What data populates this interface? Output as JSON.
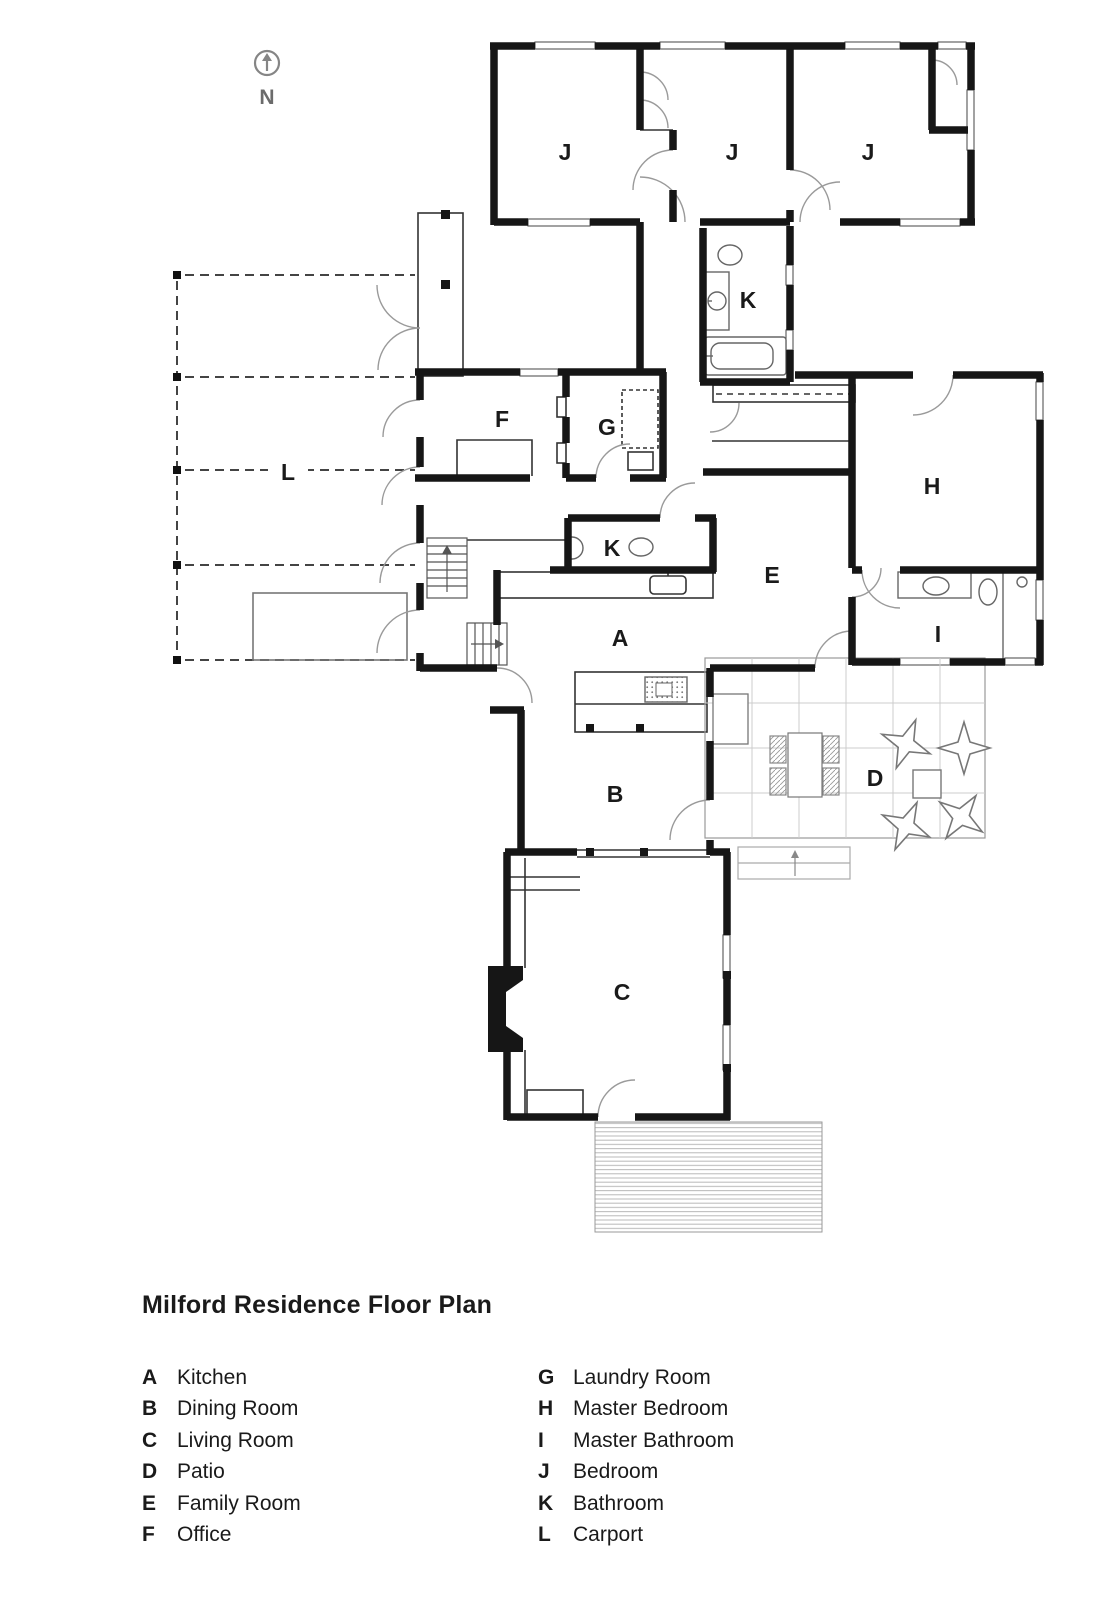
{
  "north_indicator": {
    "label": "N"
  },
  "plan": {
    "rooms": [
      {
        "id": "bedroom-1",
        "label": "J"
      },
      {
        "id": "bedroom-2",
        "label": "J"
      },
      {
        "id": "bedroom-3",
        "label": "J"
      },
      {
        "id": "bathroom-upper",
        "label": "K"
      },
      {
        "id": "office",
        "label": "F"
      },
      {
        "id": "laundry-room",
        "label": "G"
      },
      {
        "id": "carport",
        "label": "L"
      },
      {
        "id": "master-bedroom",
        "label": "H"
      },
      {
        "id": "bathroom-mid",
        "label": "K"
      },
      {
        "id": "family-room",
        "label": "E"
      },
      {
        "id": "master-bathroom",
        "label": "I"
      },
      {
        "id": "kitchen",
        "label": "A"
      },
      {
        "id": "dining-room",
        "label": "B"
      },
      {
        "id": "patio",
        "label": "D"
      },
      {
        "id": "living-room",
        "label": "C"
      }
    ]
  },
  "footer": {
    "title": "Milford Residence Floor Plan",
    "legend_left": [
      {
        "key": "A",
        "name": "Kitchen"
      },
      {
        "key": "B",
        "name": "Dining Room"
      },
      {
        "key": "C",
        "name": "Living Room"
      },
      {
        "key": "D",
        "name": "Patio"
      },
      {
        "key": "E",
        "name": "Family Room"
      },
      {
        "key": "F",
        "name": "Office"
      }
    ],
    "legend_right": [
      {
        "key": "G",
        "name": "Laundry Room"
      },
      {
        "key": "H",
        "name": "Master Bedroom"
      },
      {
        "key": "I",
        "name": "Master Bathroom"
      },
      {
        "key": "J",
        "name": "Bedroom"
      },
      {
        "key": "K",
        "name": "Bathroom"
      },
      {
        "key": "L",
        "name": "Carport"
      }
    ]
  },
  "colors": {
    "ink": "#1a1a1a",
    "wall": "#161616",
    "door_arc": "#9a9a9a",
    "dashed_line": "#444444",
    "patio_grid": "#cccccc"
  }
}
